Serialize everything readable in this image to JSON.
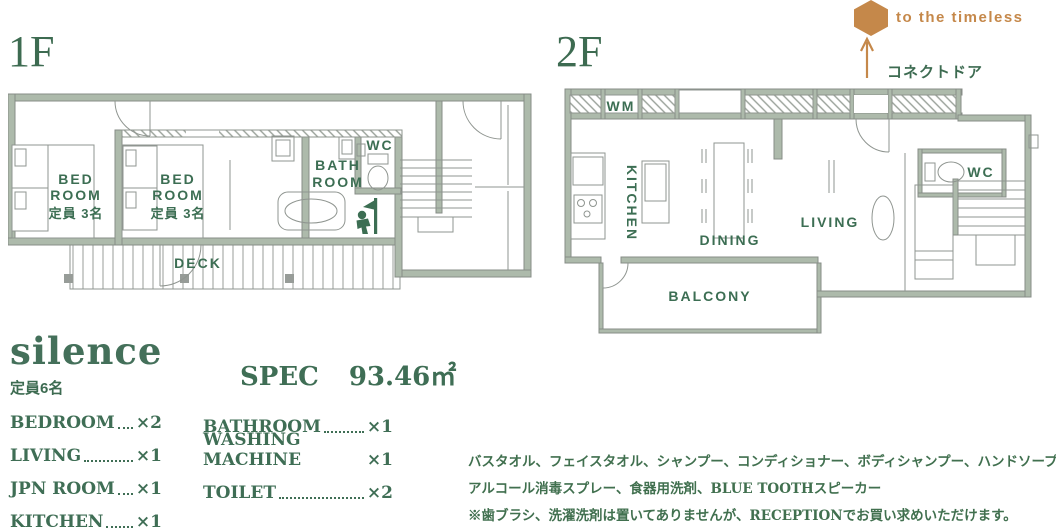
{
  "palette": {
    "wall_fill": "#adbaab",
    "outline_gray": "#8f9590",
    "text_green": "#3d6b51",
    "accent_orange": "#c5884a"
  },
  "floor1": {
    "title": "1F",
    "bedroom1": {
      "line1": "BED",
      "line2": "ROOM",
      "capacity": "定員 3名"
    },
    "bedroom2": {
      "line1": "BED",
      "line2": "ROOM",
      "capacity": "定員 3名"
    },
    "bathroom": {
      "line1": "BATH",
      "line2": "ROOM"
    },
    "wc": "WC",
    "deck": "DECK"
  },
  "floor2": {
    "title": "2F",
    "wm": "WM",
    "kitchen": "KITCHEN",
    "dining": "DINING",
    "living": "LIVING",
    "wc": "WC",
    "balcony": "BALCONY",
    "connect_door": "コネクトドア",
    "timeless": "to the timeless"
  },
  "info": {
    "title": "silence",
    "capacity": "定員6名",
    "spec_label": "SPEC",
    "spec_area": "93.46㎡",
    "col1": [
      {
        "label": "BEDROOM",
        "count": "×2"
      },
      {
        "label": "LIVING",
        "count": "×1"
      },
      {
        "label": "JPN ROOM",
        "count": "×1"
      },
      {
        "label": "KITCHEN",
        "count": "×1"
      }
    ],
    "col2": [
      {
        "label": "BATHROOM",
        "count": "×1"
      },
      {
        "label": "WASHING MACHINE",
        "count": "×1"
      },
      {
        "label": "TOILET",
        "count": "×2"
      }
    ],
    "amenities": [
      "バスタオル、フェイスタオル、シャンプー、コンディショナー、ボディシャンプー、ハンドソープ、",
      "アルコール消毒スプレー、食器用洗剤、BLUE TOOTHスピーカー",
      "※歯ブラシ、洗濯洗剤は置いてありませんが、RECEPTIONでお買い求めいただけます。"
    ]
  }
}
